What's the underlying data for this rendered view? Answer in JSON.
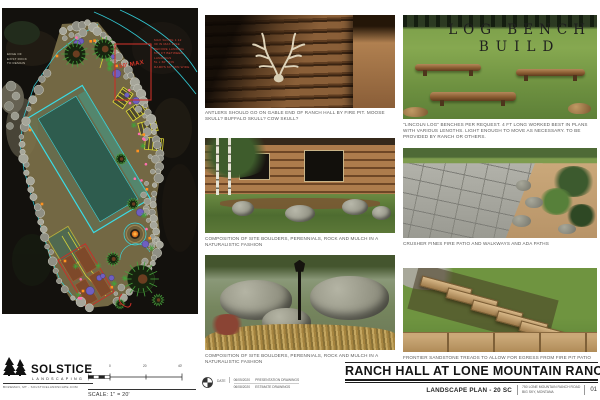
{
  "sheet": {
    "title": "RANCH HALL AT LONE MOUNTAIN RANCH",
    "subtitle": "LANDSCAPE PLAN - 20 SC",
    "address_line1": "750 LONE MOUNTAIN RANCH ROAD",
    "address_line2": "BIG SKY, MONTANA",
    "sheet_number": "01"
  },
  "logo": {
    "name": "SOLSTICE",
    "type_line": "LANDSCAPING",
    "contact": "BOZEMAN, MT - SOLSTICELANDSCAPE.COM"
  },
  "scale": {
    "label": "SCALE: 1\" = 20'",
    "ticks": [
      "10",
      "0",
      "20",
      "40'"
    ]
  },
  "revisions": {
    "label": "DATE",
    "rows": [
      {
        "date": "06/05/2020",
        "desc": "PRESENTATION DRAWINGS"
      },
      {
        "date": "06/08/2020",
        "desc": "ESTIMATE DRAWINGS"
      }
    ]
  },
  "plan": {
    "max_label": "50' MAX",
    "ramp_note": "MAX SLOPE 1:12\n30 IN MAX RISE\nBEFORE LANDING\n5X5 FT BETWEEN\nLANDINGS\n5L x 60\" MIN\nRAMPS 60\" MIN WIDE",
    "left_note": "EDGE OF\nEXIST ROCK\nTO REMAIN",
    "colors": {
      "boundary_cyan": "#35dbe6",
      "path_yellow": "#e3dd36",
      "annotation_red": "#cc3228",
      "lawn_teal": "#2e5c4e",
      "ground_tan": "#7c7049"
    }
  },
  "photos": {
    "middle": [
      {
        "caption": "ANTLERS SHOULD GO ON GABLE END OF RANCH HALL BY FIRE PIT.  MOOSE SKULL? BUFFALO SKULL?  COW SKULL?"
      },
      {
        "caption": "COMPOSITION OF SITE BOULDERS, PERENNIALS, ROCK AND MULCH IN A NATURALISTIC FASHION"
      },
      {
        "caption": "COMPOSITION OF SITE BOULDERS, PERENNIALS, ROCK AND MULCH IN A NATURALISTIC FASHION"
      }
    ],
    "right": [
      {
        "overlay_line1": "LOG BENCH",
        "overlay_line2": "BUILD",
        "caption": "\"LINCOLN LOG\" BENCHES PER REQUEST.  4 FT LONG WORKED BEST IN PLANS WITH VARIOUS LENGTHS. LIGHT ENOUGH TO MOVE AS NECESSARY.  TO BE PROVIDED BY RANCH OR OTHERS."
      },
      {
        "caption": "CRUSHER FINES FIRE PATIO AND WALKWAYS AND  ADA PATHS"
      },
      {
        "caption": "FRONTIER SANDSTONE TREADS TO ALLOW FOR EGRESS FROM FIRE PIT PATIO"
      }
    ]
  }
}
